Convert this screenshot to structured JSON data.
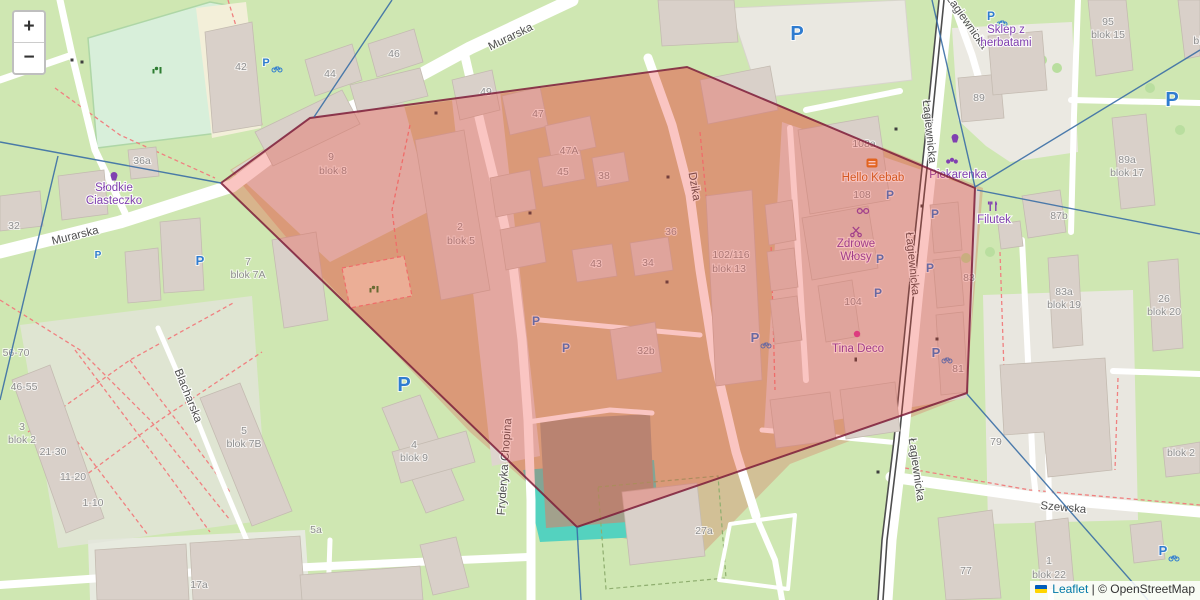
{
  "app": {
    "zoom_control": {
      "zoom_in": "+",
      "zoom_out": "−"
    },
    "attribution": {
      "leaflet": "Leaflet",
      "separator": "|",
      "copyright": "© OpenStreetMap"
    }
  },
  "colors": {
    "polygon_fill": "#ee4035",
    "polygon_stroke": "#7c1d3a",
    "blue_line": "#3a6ea5",
    "parking_blue": "#2f7cd0",
    "poi_purple": "#8040b0",
    "kebab_orange": "#c9671d",
    "street_grey": "#4e4e4e",
    "house_grey": "#8e8e8e",
    "dot_magenta": "#d63ba0",
    "playground_green": "#2e7d32"
  },
  "overlay": {
    "polygon_points": "221,183 310,118 687,67 975,188 967,393 577,527",
    "blue_segments": [
      [
        0,
        142,
        221,
        183
      ],
      [
        58,
        156,
        0,
        400
      ],
      [
        392,
        0,
        314,
        117
      ],
      [
        932,
        0,
        975,
        187
      ],
      [
        975,
        187,
        1200,
        50
      ],
      [
        977,
        190,
        1200,
        234
      ],
      [
        967,
        394,
        1148,
        600
      ],
      [
        577,
        527,
        581,
        600
      ]
    ]
  },
  "labels": {
    "streets": [
      {
        "t": "Murarska",
        "x": 76,
        "y": 239,
        "r": -14
      },
      {
        "t": "Murarska",
        "x": 512,
        "y": 40,
        "r": -26
      },
      {
        "t": "Dzika",
        "x": 691,
        "y": 187,
        "r": 80
      },
      {
        "t": "Łagiewnicka",
        "x": 964,
        "y": 24,
        "r": 55
      },
      {
        "t": "Łagiewnicka",
        "x": 926,
        "y": 132,
        "r": 84
      },
      {
        "t": "Łagiewnicka",
        "x": 909,
        "y": 264,
        "r": 84
      },
      {
        "t": "Łagiewnicka",
        "x": 913,
        "y": 470,
        "r": 82
      },
      {
        "t": "Fryderyka Chopina",
        "x": 508,
        "y": 467,
        "r": -86
      },
      {
        "t": "Blacharska",
        "x": 185,
        "y": 397,
        "r": 68
      },
      {
        "t": "Szewska",
        "x": 1063,
        "y": 511,
        "r": 5
      }
    ],
    "houses": [
      {
        "t": "42",
        "x": 241,
        "y": 70
      },
      {
        "t": "44",
        "x": 330,
        "y": 77
      },
      {
        "t": "46",
        "x": 394,
        "y": 57
      },
      {
        "t": "36a",
        "x": 142,
        "y": 164
      },
      {
        "t": "32",
        "x": 14,
        "y": 229
      },
      {
        "t": "49",
        "x": 486,
        "y": 95
      },
      {
        "t": "47",
        "x": 538,
        "y": 117
      },
      {
        "t": "47A",
        "x": 569,
        "y": 154
      },
      {
        "t": "45",
        "x": 563,
        "y": 175
      },
      {
        "t": "38",
        "x": 604,
        "y": 179
      },
      {
        "t": "43",
        "x": 596,
        "y": 267
      },
      {
        "t": "34",
        "x": 648,
        "y": 266
      },
      {
        "t": "36",
        "x": 671,
        "y": 235
      },
      {
        "t": "9",
        "x": 331,
        "y": 160
      },
      {
        "t": "blok 8",
        "x": 333,
        "y": 174
      },
      {
        "t": "2",
        "x": 460,
        "y": 230
      },
      {
        "t": "blok 5",
        "x": 461,
        "y": 244
      },
      {
        "t": "102/116",
        "x": 731,
        "y": 258
      },
      {
        "t": "blok 13",
        "x": 729,
        "y": 272
      },
      {
        "t": "108a",
        "x": 864,
        "y": 147
      },
      {
        "t": "108",
        "x": 862,
        "y": 198
      },
      {
        "t": "104",
        "x": 853,
        "y": 305
      },
      {
        "t": "32b",
        "x": 646,
        "y": 354
      },
      {
        "t": "81",
        "x": 958,
        "y": 372
      },
      {
        "t": "83",
        "x": 969,
        "y": 281
      },
      {
        "t": "7",
        "x": 248,
        "y": 265
      },
      {
        "t": "blok 7A",
        "x": 248,
        "y": 278
      },
      {
        "t": "3",
        "x": 22,
        "y": 430
      },
      {
        "t": "blok 2",
        "x": 22,
        "y": 443
      },
      {
        "t": "56-70",
        "x": 16,
        "y": 356
      },
      {
        "t": "46-55",
        "x": 24,
        "y": 390
      },
      {
        "t": "21-30",
        "x": 53,
        "y": 455
      },
      {
        "t": "11-20",
        "x": 73,
        "y": 480
      },
      {
        "t": "1-10",
        "x": 93,
        "y": 506
      },
      {
        "t": "5",
        "x": 244,
        "y": 434
      },
      {
        "t": "blok 7B",
        "x": 244,
        "y": 447
      },
      {
        "t": "4",
        "x": 414,
        "y": 448
      },
      {
        "t": "blok 9",
        "x": 414,
        "y": 461
      },
      {
        "t": "5a",
        "x": 316,
        "y": 533
      },
      {
        "t": "17a",
        "x": 199,
        "y": 588
      },
      {
        "t": "27a",
        "x": 704,
        "y": 534
      },
      {
        "t": "89",
        "x": 979,
        "y": 101
      },
      {
        "t": "95",
        "x": 1108,
        "y": 25
      },
      {
        "t": "blok 15",
        "x": 1108,
        "y": 38
      },
      {
        "t": "blok",
        "x": 1203,
        "y": 44
      },
      {
        "t": "89a",
        "x": 1127,
        "y": 163
      },
      {
        "t": "blok 17",
        "x": 1127,
        "y": 176
      },
      {
        "t": "87b",
        "x": 1059,
        "y": 219
      },
      {
        "t": "83a",
        "x": 1064,
        "y": 295
      },
      {
        "t": "blok 19",
        "x": 1064,
        "y": 308
      },
      {
        "t": "26",
        "x": 1164,
        "y": 302
      },
      {
        "t": "blok 20",
        "x": 1164,
        "y": 315
      },
      {
        "t": "79",
        "x": 996,
        "y": 445
      },
      {
        "t": "77",
        "x": 966,
        "y": 574
      },
      {
        "t": "1",
        "x": 1049,
        "y": 564
      },
      {
        "t": "blok 22",
        "x": 1049,
        "y": 578
      },
      {
        "t": "blok 2",
        "x": 1181,
        "y": 456
      }
    ],
    "pois": [
      {
        "lines": [
          "Słodkie",
          "Ciasteczko"
        ],
        "x": 114,
        "y": 191
      },
      {
        "lines": [
          "Hello Kebab"
        ],
        "x": 873,
        "y": 181,
        "color": "#c9671d"
      },
      {
        "lines": [
          "Piekarenka"
        ],
        "x": 958,
        "y": 178
      },
      {
        "lines": [
          "Zdrowe",
          "Włosy"
        ],
        "x": 856,
        "y": 247
      },
      {
        "lines": [
          "Tina Deco"
        ],
        "x": 858,
        "y": 352
      },
      {
        "lines": [
          "Filutek"
        ],
        "x": 994,
        "y": 223
      },
      {
        "lines": [
          "Sklep z",
          "herbatami"
        ],
        "x": 1006,
        "y": 33
      }
    ]
  },
  "markers": {
    "parking": [
      {
        "x": 98,
        "y": 258,
        "size": 10
      },
      {
        "x": 200,
        "y": 265,
        "size": 13
      },
      {
        "x": 266,
        "y": 66,
        "size": 11,
        "bike": true
      },
      {
        "x": 797,
        "y": 40,
        "size": 20
      },
      {
        "x": 404,
        "y": 391,
        "size": 20
      },
      {
        "x": 536,
        "y": 325,
        "size": 12
      },
      {
        "x": 566,
        "y": 352,
        "size": 12
      },
      {
        "x": 890,
        "y": 199,
        "size": 12
      },
      {
        "x": 935,
        "y": 218,
        "size": 12
      },
      {
        "x": 880,
        "y": 263,
        "size": 12
      },
      {
        "x": 930,
        "y": 272,
        "size": 12
      },
      {
        "x": 878,
        "y": 297,
        "size": 12
      },
      {
        "x": 936,
        "y": 357,
        "size": 13,
        "bike": true
      },
      {
        "x": 755,
        "y": 342,
        "size": 13,
        "bike": true
      },
      {
        "x": 1172,
        "y": 106,
        "size": 20
      },
      {
        "x": 1163,
        "y": 555,
        "size": 13,
        "bike": true
      },
      {
        "x": 991,
        "y": 20,
        "size": 12,
        "bike": true
      }
    ]
  },
  "icons": [
    {
      "name": "confectionery-icon",
      "kind": "cupcake",
      "x": 114,
      "y": 176,
      "color": "#8040b0"
    },
    {
      "name": "fast-food-icon",
      "kind": "fastfood",
      "x": 872,
      "y": 163,
      "color": "#dd7518"
    },
    {
      "name": "confectionery-icon",
      "kind": "cupcake",
      "x": 955,
      "y": 138,
      "color": "#8040b0"
    },
    {
      "name": "bakery-icon",
      "kind": "croissant",
      "x": 952,
      "y": 161,
      "color": "#8040b0"
    },
    {
      "name": "optician-icon",
      "kind": "glasses",
      "x": 863,
      "y": 211,
      "color": "#8040b0"
    },
    {
      "name": "hairdresser-icon",
      "kind": "scissors",
      "x": 856,
      "y": 231,
      "color": "#8040b0"
    },
    {
      "name": "restaurant-icon",
      "kind": "restaurant",
      "x": 993,
      "y": 206,
      "color": "#8040b0"
    },
    {
      "name": "shop-dot-icon",
      "kind": "dot",
      "x": 857,
      "y": 334,
      "color": "#d63ba0"
    },
    {
      "name": "playground-icon",
      "kind": "playground",
      "x": 157,
      "y": 70,
      "color": "#2e7d32"
    },
    {
      "name": "playground-icon",
      "kind": "playground",
      "x": 374,
      "y": 289,
      "color": "#2e7d32"
    }
  ]
}
